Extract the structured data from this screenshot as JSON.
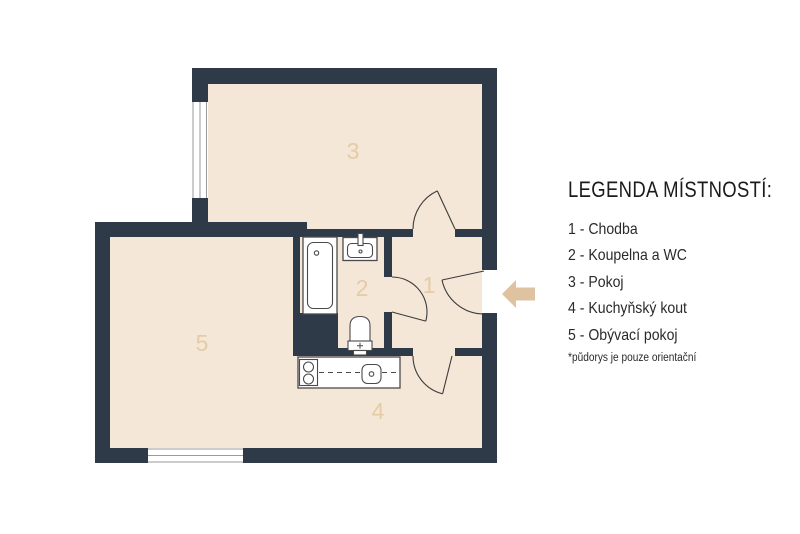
{
  "colors": {
    "wall": "#2e3a47",
    "floor": "#f4e7d7",
    "room_label": "#e5cba6",
    "arrow": "#dfc3a0",
    "legend_text": "#2a2a2a",
    "fixture_stroke": "#4a4a4a",
    "background": "#ffffff"
  },
  "legend": {
    "title": "LEGENDA MÍSTNOSTÍ:",
    "items": [
      {
        "text": "1 - Chodba"
      },
      {
        "text": "2 - Koupelna a WC"
      },
      {
        "text": "3 - Pokoj"
      },
      {
        "text": "4 - Kuchyňský kout"
      },
      {
        "text": "5 - Obývací pokoj"
      }
    ],
    "footnote": "*půdorys je pouze orientační"
  },
  "plan": {
    "room_labels": {
      "hallway": "1",
      "bathroom": "2",
      "room": "3",
      "kitchenette": "4",
      "living_room": "5"
    },
    "entrance_arrow_direction": "left"
  }
}
